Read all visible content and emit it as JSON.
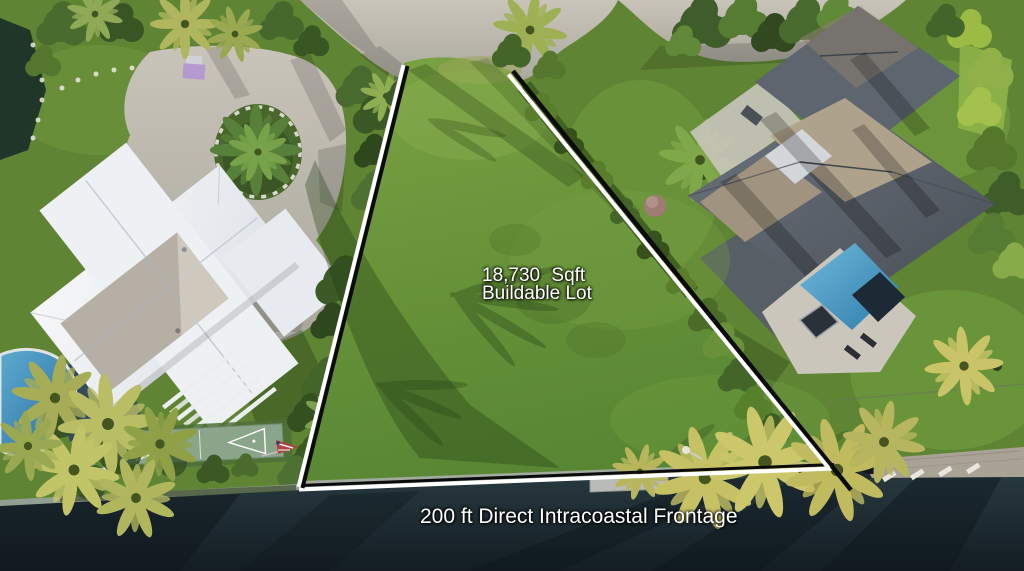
{
  "scene": {
    "type": "aerial-real-estate-photo",
    "overlays": {
      "lot_size_line1": "18,730 Sqft",
      "lot_size_line2": "Buildable Lot",
      "frontage": "200 ft Direct Intracoastal Frontage"
    },
    "palette": {
      "label_text": "#ffffff",
      "boundary_white": "#ffffff",
      "boundary_black": "#0b0b0b",
      "water": "#22333b",
      "water_deep": "#131d23",
      "lawn": "#5f8434",
      "lot_grass": "#6d9540",
      "road": "#bdb8ae",
      "white_roof": "#eef1f4",
      "gray_roof": "#5d656e",
      "roof_tan": "#b3a58d",
      "pool_blue": "#3c86b4",
      "hedge": "#9cbb45",
      "palm": "#c5c164",
      "seawall": "#a5aca3",
      "dock": "#a9a396"
    }
  }
}
